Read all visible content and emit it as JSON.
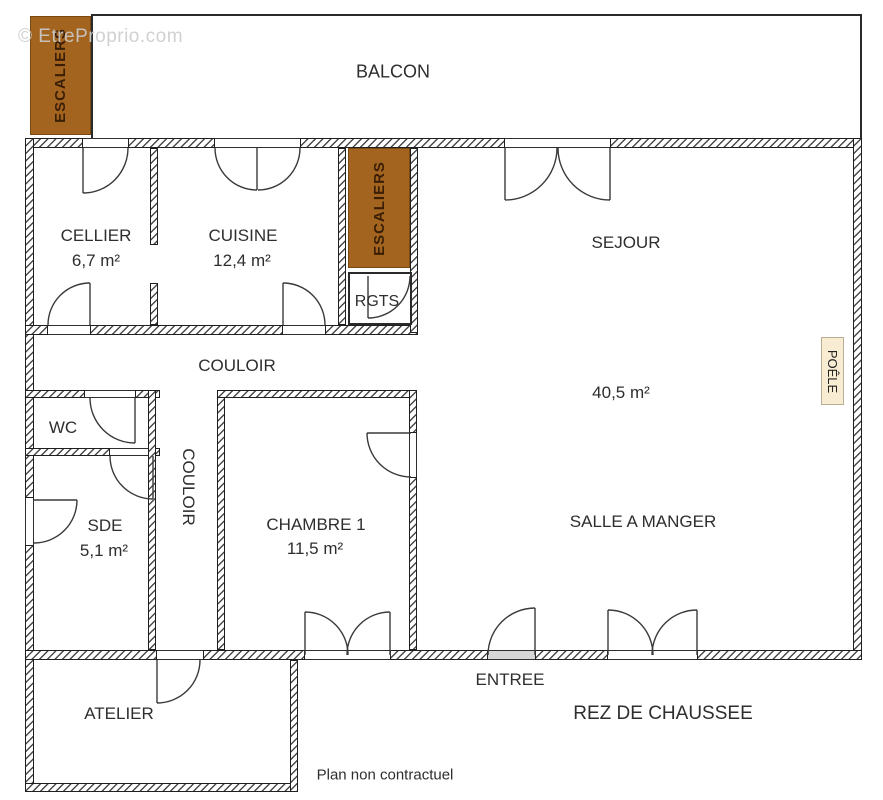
{
  "watermark": "© EtreProprio.com",
  "title": "REZ DE CHAUSSEE",
  "disclaimer": "Plan non contractuel",
  "colors": {
    "stairs_brown": "#a3641f",
    "stairs_border": "#7a4810",
    "stairs_text": "#3a1e06",
    "poele_bg": "#f8ecd2",
    "poele_border": "#b9ae95",
    "line_dark": "#2e2e2e",
    "watermark_gray": "#cccccc"
  },
  "rooms": {
    "balcon": {
      "name": "BALCON"
    },
    "escaliers_top": {
      "name": "ESCALIERS"
    },
    "escaliers_mid": {
      "name": "ESCALIERS"
    },
    "cellier": {
      "name": "CELLIER",
      "area": "6,7 m²"
    },
    "cuisine": {
      "name": "CUISINE",
      "area": "12,4 m²"
    },
    "rgts": {
      "name": "RGTS"
    },
    "sejour": {
      "name": "SEJOUR",
      "area": "40,5 m²"
    },
    "salle_a_manger": {
      "name": "SALLE A MANGER"
    },
    "couloir": {
      "name": "COULOIR"
    },
    "couloir_vertical": {
      "name": "COULOIR"
    },
    "wc": {
      "name": "WC"
    },
    "sde": {
      "name": "SDE",
      "area": "5,1 m²"
    },
    "chambre1": {
      "name": "CHAMBRE 1",
      "area": "11,5 m²"
    },
    "poele": {
      "name": "POÊLE"
    },
    "entree": {
      "name": "ENTREE"
    },
    "atelier": {
      "name": "ATELIER"
    }
  }
}
